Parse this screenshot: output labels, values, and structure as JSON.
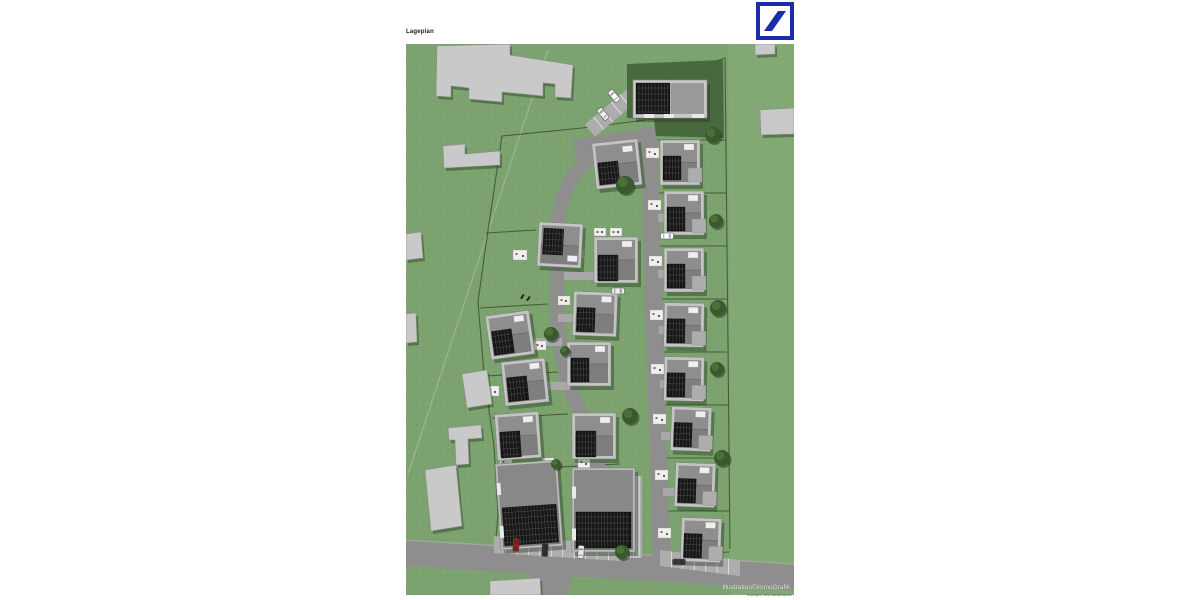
{
  "header": {
    "title": "Lageplan"
  },
  "logo": {
    "name": "Deutsche Bank",
    "blue": "#1B2DA8"
  },
  "credit": {
    "line1": "Illustration©immoGrafik",
    "line2": "Copyrights, nicht maßstabsgetreu"
  },
  "map": {
    "colors": {
      "grass": "#7CA26F",
      "grassLight": "#86AD79",
      "boundary": "#3C5930",
      "pathLine": "#9FB890",
      "road": "#8E8E8E",
      "roadEdge": "#A6A6A6",
      "lot": "#ADADAD",
      "divider": "#E8E8E8",
      "bldg": "#C9C9C9",
      "bldgEdge": "#8F8F8F",
      "body": "#C4C4C4",
      "roof": "#8E8E8E",
      "roofS": "#7E7E7E",
      "roofDark": "#7A7A7A",
      "solar": "#161616",
      "solarLine": "#4F4F4F",
      "hedge": "#46663A",
      "treeDark": "#39592E",
      "treeLight": "#4A7038",
      "shadow": "rgba(25,55,20,0.40)",
      "white": "#EFEFEF",
      "drive": "#A8A8A8"
    },
    "existing_buildings": [
      "31,2 104,0 104,11 167,21 165,54 149,53 149,40 137,39 137,52 96,48 96,58 63,55 63,44 45,42 45,53 30,52",
      "37,102 59,100 59,110 94,107 94,121 38,124",
      "0,190 15,188 17,214 0,216",
      "0,270 10,269 11,298 0,299",
      "56,330 81,326 86,360 61,364",
      "42,384 75,381 76,394 62,395 63,420 50,421 49,396 43,396",
      "19,426 50,421 56,482 25,487",
      "84,537 134,534 135,551 84,551",
      "349,0 369,0 369,10 349,11",
      "354,66 388,64 388,90 355,91"
    ],
    "roads": {
      "bottom": "0,497 388,521 388,546 0,522",
      "bottom_edge": [
        [
          0,
          496
        ],
        [
          388,
          520
        ]
      ],
      "stub": "128,515 167,518 162,551 122,551",
      "vertical": "234,84 251,83 264,514 247,516",
      "plaza": "166,96 246,84 249,104 172,118",
      "internal": "M 244,90 C 214,96 192,106 176,122 C 160,138 153,158 152,182 L 151,256 C 151,292 156,322 166,350 C 174,372 186,384 190,404 L 195,452 L 196,502"
    },
    "parking": [
      {
        "quad": "88,492 214,500 214,517 88,509",
        "n": 11
      },
      {
        "quad": "254,506 334,516 334,532 254,522",
        "n": 7
      },
      {
        "quad": "178.7,80.5 223.1,43.3 233.3,55.5 188.9,92.7",
        "n": 5
      },
      {
        "quad": "216,432 236,432 236,514 216,514",
        "n": 7
      }
    ],
    "driveways": [
      [
        252,
        170,
        16,
        8
      ],
      [
        252,
        226,
        16,
        8
      ],
      [
        253,
        282,
        16,
        8
      ],
      [
        254,
        336,
        16,
        8
      ],
      [
        255,
        388,
        16,
        8
      ],
      [
        257,
        444,
        16,
        8
      ],
      [
        152,
        206,
        26,
        8
      ],
      [
        158,
        228,
        32,
        8
      ],
      [
        126,
        294,
        30,
        8
      ],
      [
        152,
        270,
        16,
        8
      ],
      [
        141,
        338,
        24,
        8
      ]
    ],
    "patios": [
      [
        107,
        206,
        14,
        10
      ],
      [
        145,
        206,
        14,
        9
      ],
      [
        188,
        184,
        12,
        8
      ],
      [
        204,
        184,
        12,
        8
      ],
      [
        128,
        297,
        12,
        9
      ],
      [
        152,
        252,
        12,
        9
      ],
      [
        94,
        414,
        12,
        10
      ],
      [
        136,
        414,
        12,
        10
      ],
      [
        172,
        414,
        12,
        10
      ],
      [
        80,
        342,
        13,
        10
      ],
      [
        240,
        104,
        13,
        10
      ],
      [
        242,
        156,
        13,
        10
      ],
      [
        243,
        212,
        13,
        10
      ],
      [
        244,
        266,
        13,
        10
      ],
      [
        245,
        320,
        13,
        10
      ],
      [
        247,
        370,
        13,
        10
      ],
      [
        249,
        426,
        13,
        10
      ],
      [
        252,
        484,
        13,
        10
      ]
    ],
    "hedge": "221,20 317,16 318,94 250,92 248,76 221,74",
    "houses": [
      {
        "x": 227,
        "y": 36,
        "w": 74,
        "h": 38,
        "rot": 0,
        "t": "hall",
        "s": [
          3,
          3,
          34,
          31
        ]
      },
      {
        "x": 188,
        "y": 97,
        "w": 46,
        "h": 46,
        "rot": -6,
        "s": [
          4,
          20,
          20,
          22
        ],
        "d": [
          30,
          6,
          10,
          6
        ]
      },
      {
        "x": 254,
        "y": 96,
        "w": 40,
        "h": 45,
        "rot": 0,
        "s": [
          3,
          16,
          18,
          24
        ],
        "d": [
          24,
          4,
          10,
          6
        ],
        "g": [
          28,
          28,
          14,
          14
        ]
      },
      {
        "x": 132,
        "y": 179,
        "w": 44,
        "h": 44,
        "rot": 3,
        "s": [
          5,
          6,
          20,
          26
        ],
        "d": [
          30,
          32,
          10,
          6
        ]
      },
      {
        "x": 188,
        "y": 193,
        "w": 44,
        "h": 46,
        "rot": 0,
        "s": [
          4,
          18,
          20,
          26
        ],
        "d": [
          28,
          4,
          10,
          6
        ]
      },
      {
        "x": 258,
        "y": 147,
        "w": 40,
        "h": 44,
        "rot": 0,
        "s": [
          3,
          16,
          18,
          24
        ],
        "d": [
          24,
          4,
          10,
          6
        ],
        "g": [
          28,
          28,
          14,
          14
        ]
      },
      {
        "x": 258,
        "y": 204,
        "w": 40,
        "h": 44,
        "rot": 0,
        "s": [
          3,
          16,
          18,
          24
        ],
        "d": [
          24,
          4,
          10,
          6
        ],
        "g": [
          28,
          28,
          14,
          14
        ]
      },
      {
        "x": 82,
        "y": 269,
        "w": 44,
        "h": 44,
        "rot": -8,
        "s": [
          4,
          16,
          20,
          24
        ],
        "d": [
          28,
          4,
          10,
          6
        ]
      },
      {
        "x": 167,
        "y": 248,
        "w": 44,
        "h": 44,
        "rot": 2,
        "s": [
          4,
          16,
          18,
          24
        ],
        "d": [
          28,
          4,
          10,
          6
        ]
      },
      {
        "x": 258,
        "y": 259,
        "w": 40,
        "h": 44,
        "rot": 1,
        "s": [
          3,
          16,
          18,
          24
        ],
        "d": [
          24,
          4,
          10,
          6
        ],
        "g": [
          28,
          28,
          14,
          14
        ]
      },
      {
        "x": 97,
        "y": 316,
        "w": 44,
        "h": 44,
        "rot": -6,
        "s": [
          4,
          16,
          20,
          24
        ],
        "d": [
          28,
          4,
          10,
          6
        ]
      },
      {
        "x": 161,
        "y": 298,
        "w": 44,
        "h": 44,
        "rot": 0,
        "s": [
          4,
          16,
          18,
          24
        ],
        "d": [
          28,
          4,
          10,
          6
        ]
      },
      {
        "x": 258,
        "y": 313,
        "w": 40,
        "h": 44,
        "rot": 1,
        "s": [
          3,
          16,
          18,
          24
        ],
        "d": [
          24,
          4,
          10,
          6
        ],
        "g": [
          28,
          28,
          14,
          14
        ]
      },
      {
        "x": 90,
        "y": 369,
        "w": 44,
        "h": 46,
        "rot": -4,
        "s": [
          4,
          18,
          20,
          26
        ],
        "d": [
          28,
          4,
          10,
          6
        ]
      },
      {
        "x": 166,
        "y": 369,
        "w": 44,
        "h": 46,
        "rot": 0,
        "s": [
          4,
          18,
          20,
          26
        ],
        "d": [
          28,
          4,
          10,
          6
        ]
      },
      {
        "x": 265,
        "y": 363,
        "w": 40,
        "h": 44,
        "rot": 2,
        "s": [
          3,
          16,
          18,
          24
        ],
        "d": [
          24,
          4,
          10,
          6
        ],
        "g": [
          28,
          28,
          14,
          14
        ]
      },
      {
        "x": 269,
        "y": 419,
        "w": 40,
        "h": 44,
        "rot": 2,
        "s": [
          3,
          16,
          18,
          24
        ],
        "d": [
          24,
          4,
          10,
          6
        ],
        "g": [
          28,
          28,
          14,
          14
        ]
      },
      {
        "x": 92,
        "y": 418,
        "w": 62,
        "h": 86,
        "rot": -4,
        "t": "large",
        "s": [
          4,
          44,
          54,
          38
        ]
      },
      {
        "x": 166,
        "y": 424,
        "w": 63,
        "h": 84,
        "rot": 0,
        "t": "large",
        "s": [
          4,
          44,
          55,
          36
        ]
      },
      {
        "x": 275,
        "y": 474,
        "w": 40,
        "h": 44,
        "rot": 2,
        "s": [
          3,
          16,
          18,
          24
        ],
        "d": [
          24,
          4,
          10,
          6
        ],
        "g": [
          28,
          28,
          14,
          14
        ]
      }
    ],
    "trees": [
      [
        219,
        141,
        9
      ],
      [
        307,
        91,
        8
      ],
      [
        310,
        177,
        7
      ],
      [
        312,
        264,
        8
      ],
      [
        311,
        325,
        7
      ],
      [
        316,
        414,
        8
      ],
      [
        145,
        290,
        7
      ],
      [
        159,
        307,
        5
      ],
      [
        224,
        372,
        8
      ],
      [
        150,
        420,
        5
      ],
      [
        216,
        508,
        7
      ]
    ],
    "cars": [
      [
        208,
        52,
        -40,
        "#FFFFFF"
      ],
      [
        197,
        70,
        -40,
        "#F0F0F0"
      ],
      [
        261,
        192,
        90,
        "#FFFFFF"
      ],
      [
        212,
        247,
        90,
        "#EDEDED"
      ],
      [
        110,
        501,
        3,
        "#8F2020"
      ],
      [
        139,
        506,
        3,
        "#303030"
      ],
      [
        175,
        508,
        3,
        "#ECECEC"
      ],
      [
        273,
        518,
        90,
        "#3A3A3A"
      ]
    ],
    "marks": [
      [
        117,
        250
      ],
      [
        123,
        252
      ]
    ],
    "property_lines": [
      [
        [
          240,
          42
        ],
        [
          319,
          14
        ],
        [
          322,
          300
        ],
        [
          324,
          505
        ]
      ],
      [
        [
          252,
          96
        ],
        [
          320,
          96
        ]
      ],
      [
        [
          252,
          149
        ],
        [
          320,
          149
        ]
      ],
      [
        [
          253,
          202
        ],
        [
          321,
          202
        ]
      ],
      [
        [
          254,
          255
        ],
        [
          321,
          255
        ]
      ],
      [
        [
          255,
          308
        ],
        [
          321,
          308
        ]
      ],
      [
        [
          256,
          361
        ],
        [
          322,
          361
        ]
      ],
      [
        [
          257,
          414
        ],
        [
          322,
          414
        ]
      ],
      [
        [
          258,
          467
        ],
        [
          323,
          467
        ]
      ],
      [
        [
          259,
          512
        ],
        [
          323,
          508
        ]
      ],
      [
        [
          96,
          92
        ],
        [
          80,
          200
        ],
        [
          72,
          258
        ],
        [
          78,
          330
        ],
        [
          88,
          402
        ],
        [
          92,
          470
        ],
        [
          90,
          494
        ]
      ],
      [
        [
          80,
          189
        ],
        [
          130,
          186
        ]
      ],
      [
        [
          74,
          264
        ],
        [
          142,
          260
        ]
      ],
      [
        [
          80,
          332
        ],
        [
          152,
          328
        ]
      ],
      [
        [
          86,
          374
        ],
        [
          162,
          370
        ]
      ],
      [
        [
          90,
          426
        ],
        [
          214,
          420
        ]
      ],
      [
        [
          96,
          92
        ],
        [
          176,
          84
        ]
      ],
      [
        [
          176,
          84
        ],
        [
          240,
          76
        ]
      ]
    ],
    "path_line": [
      [
        142,
        6
      ],
      [
        2,
        430
      ]
    ],
    "light_overlay": "322,0 388,0 388,551 324,551"
  }
}
